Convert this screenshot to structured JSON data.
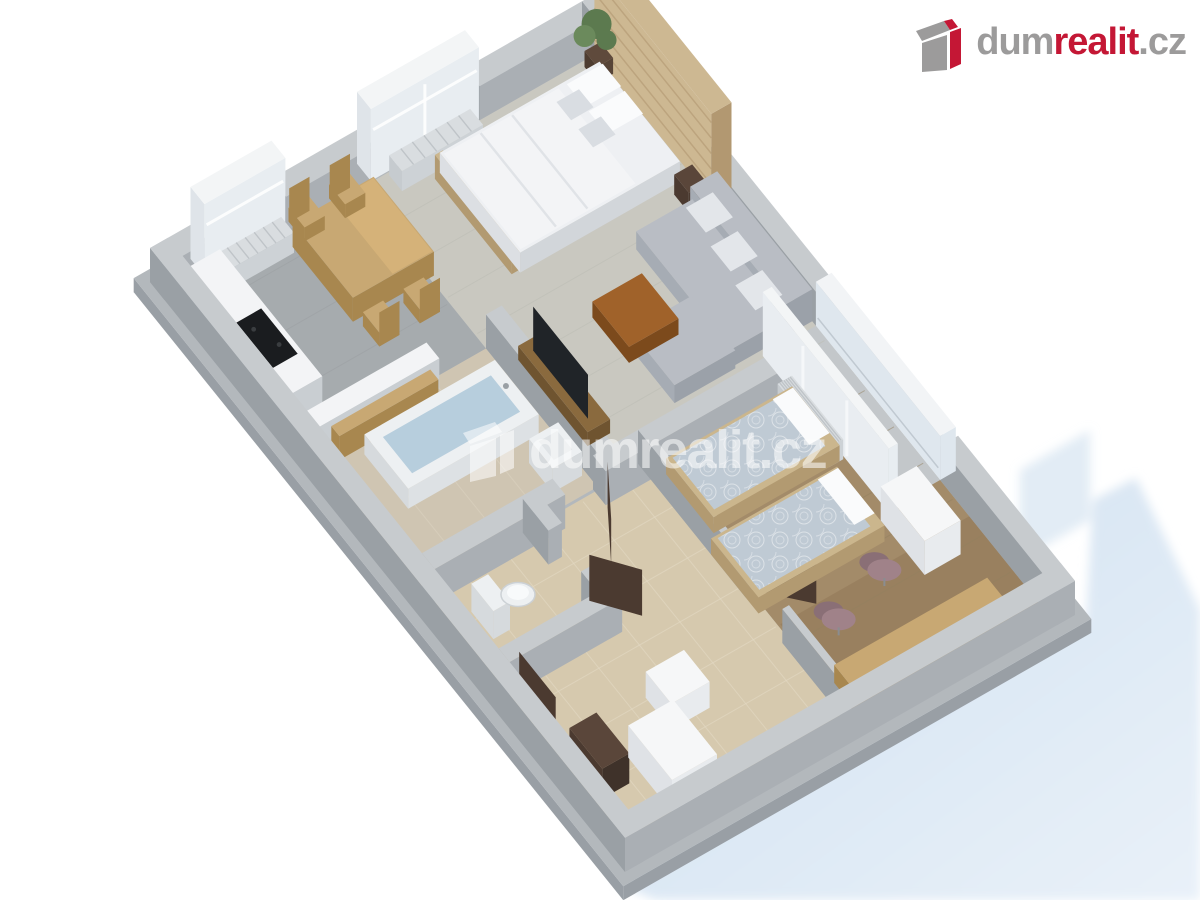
{
  "brand": {
    "logo_icon": "dumrealit-box-icon",
    "dum": "dum",
    "realit": "realit",
    "cz": ".cz",
    "red": "#c41735",
    "gray": "#9c9b9b"
  },
  "watermark": {
    "icon": "dumrealit-box-icon-white",
    "text": "dumrealit.cz",
    "opacity": 0.55
  },
  "colors": {
    "bg": "#ffffff",
    "shadow_from": "#cfdfef",
    "shadow_to": "#e9f1f9",
    "slab_top": "#b3b8bc",
    "slab_side": "#999fa5",
    "wall_top": "#c7cbce",
    "wall_sw": "#9aa0a5",
    "wall_se": "#aaafb4",
    "floor_concrete": "#a6abae",
    "floor_wood_light": "#c9c8c0",
    "floor_tile": "#d6c9ae",
    "tile_line": "#e2d8c2",
    "floor_bath": "#cfc5b2",
    "floor_wood_brown": "#a38b69",
    "plank_line_light": "#bcbdb4",
    "plank_line_brown": "#93805f",
    "balcony_floor": "#c3c7ca",
    "wood_head": "#cdb892",
    "wood_head_side": "#b29871",
    "window_top": "#f3f5f6",
    "window_glass": "#e8edf1",
    "window_side": "#dfe4e9",
    "radiator": "#d9dde0",
    "radiator_rib": "#b9bec3",
    "bed_top": "#eef0f3",
    "bed_sw": "#dcdfe3",
    "bed_se": "#d2d6da",
    "duvet": "#f3f4f6",
    "duvet_line": "#dfe2e6",
    "pillow": "#fafbfc",
    "pillow_gray": "#d9dde2",
    "bed_wood": "#cbb68d",
    "bed_wood_side": "#b29a71",
    "sofa": "#b9bdc4",
    "sofa_sw": "#a6acb4",
    "sofa_se": "#9ba1a9",
    "sofa_pillow": "#e3e6ea",
    "table_brown": "#a0622a",
    "table_brown_dark": "#7c4a1c",
    "dining_wood": "#c8a873",
    "dining_wood_dark": "#a8874f",
    "dining_wood_hi": "#d9b57b",
    "counter_white": "#f3f4f6",
    "counter_side": "#c9ced2",
    "cooktop": "#1a1c1f",
    "tub_water": "#b7cedd",
    "fixture_white": "#edf0f2",
    "fixture_side": "#d6dadd",
    "door_dark": "#4b3a30",
    "door_top": "#5a463a",
    "mattress_blue": "#bfcad4",
    "chair_mauve": "#a08289",
    "chair_mauve_dark": "#8a6f76",
    "glass": "#dfe7ee",
    "frame_white": "#f2f4f6",
    "tv_black": "#202428",
    "tv_cab": "#8a6a3e",
    "tv_cab_side": "#6f5430",
    "wardrobe_white": "#f6f7f8",
    "wardrobe_side": "#dfe2e6",
    "plant_green": "#5c7a4f",
    "plant_green_hi": "#6b8a5c",
    "pot_brown": "#5f4a3c"
  }
}
